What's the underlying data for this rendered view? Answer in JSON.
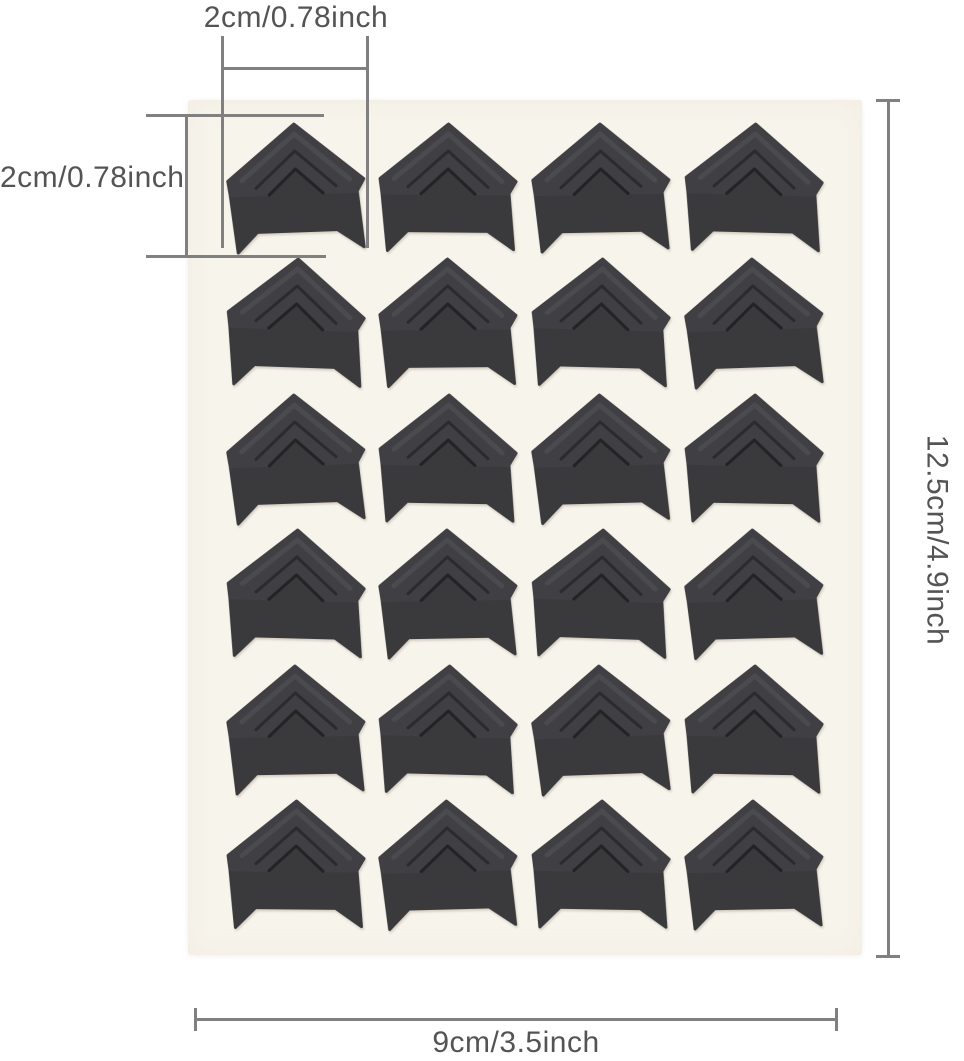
{
  "product": {
    "name": "Black self-adhesive photo corner stickers sheet",
    "rows": 6,
    "columns": 4,
    "piece_count": 24,
    "colors": {
      "corner": "#3a3a3d",
      "corner_pocket": "#403f43",
      "ridge_highlight": "#4b4a4f",
      "ridge_shadow": "#2b2b2e",
      "notch_shadow": "#232326",
      "sheet": "#f7f4ec",
      "background": "#ffffff"
    },
    "piece_rotations_deg": [
      -2,
      0.5,
      -1,
      1.5,
      2,
      -0.5,
      1.5,
      -2,
      -2,
      1,
      -1.5,
      1,
      1.5,
      -1,
      2,
      -1.5,
      -1,
      1.5,
      -2,
      1,
      0.5,
      -1.5,
      1,
      -1
    ]
  },
  "annotations": {
    "line_color": "#808080",
    "text_color": "#545454",
    "corner_width_label": "2cm/0.78inch",
    "corner_height_label": "2cm/0.78inch",
    "sheet_height_label": "12.5cm/4.9inch",
    "sheet_width_label": "9cm/3.5inch"
  }
}
